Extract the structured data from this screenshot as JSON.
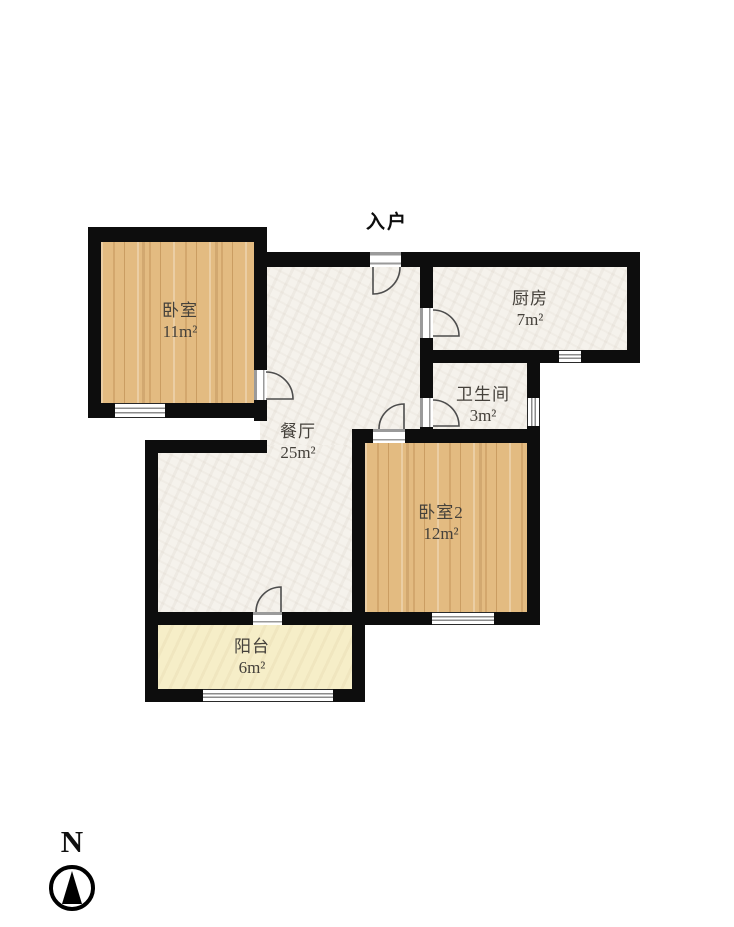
{
  "entry_label": "入户",
  "compass": {
    "north_label": "N"
  },
  "rooms": [
    {
      "id": "bedroom1",
      "name": "卧室",
      "area": "11m²"
    },
    {
      "id": "kitchen",
      "name": "厨房",
      "area": "7m²"
    },
    {
      "id": "bathroom",
      "name": "卫生间",
      "area": "3m²"
    },
    {
      "id": "dining",
      "name": "餐厅",
      "area": "25m²"
    },
    {
      "id": "bedroom2",
      "name": "卧室2",
      "area": "12m²"
    },
    {
      "id": "balcony",
      "name": "阳台",
      "area": "6m²"
    }
  ],
  "colors": {
    "wall": "#0d0d0d",
    "wood_floor": "#e3bb81",
    "tile_floor": "#f5f2ec",
    "balcony_floor": "#f6eec8",
    "label_text": "#45413b"
  }
}
